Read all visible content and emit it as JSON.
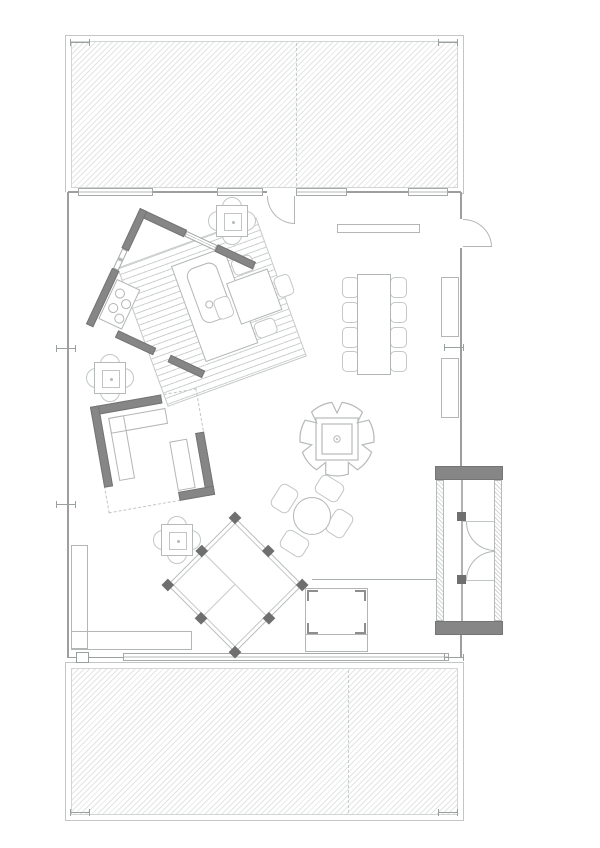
{
  "plan": {
    "title": "Single-storey cabin floor plan with north and south hatched decks",
    "drawing_type": "architectural floor plan, grayscale line drawing, no text labels",
    "colors": {
      "background": "#ffffff",
      "line": "#b3b6b6",
      "line_light": "#ced1d1",
      "wall_light": "#9e9e9e",
      "wall_dark": "#868686",
      "post_dark": "#6f6f6f",
      "deck_hatch": "#e3e4e4"
    },
    "fireplace_notches": 7,
    "areas": [
      {
        "id": "upper-deck",
        "label": "hatched deck terrace (top), split by a dashed seam, corner column ticks"
      },
      {
        "id": "main-room",
        "label": "open plan living / dining hall"
      },
      {
        "id": "kitchen",
        "label": "rotated square kitchen enclosure (25deg) with segmented dark walls and windows"
      },
      {
        "id": "floor-platform",
        "label": "striped timber floor platform rotated -20deg under kitchen island and table"
      },
      {
        "id": "room2",
        "label": "rotated square room (-10deg) with dark wall segments, dashed glazing and L cabinet"
      },
      {
        "id": "entry-vestibule",
        "label": "entry airlock on east wall with two dark end walls, hatched jambs and double swing doors"
      },
      {
        "id": "lower-deck",
        "label": "hatched deck terrace (bottom) with long window band and seam"
      }
    ],
    "furniture": [
      {
        "id": "range",
        "label": "4-burner cooktop in kitchen west corner",
        "burners": 4
      },
      {
        "id": "island",
        "label": "kitchen island with rounded sink and tap circle"
      },
      {
        "id": "platform-table",
        "label": "square table with 4 chairs on striped platform",
        "seats": 4
      },
      {
        "id": "cafe-table-north",
        "label": "small square table with 4 round chairs near north door",
        "seats": 4
      },
      {
        "id": "cafe-table-west",
        "label": "small square table with 4 round chairs at west wall",
        "seats": 4
      },
      {
        "id": "cafe-table-south",
        "label": "small square table with 4 round chairs south of kitchen",
        "seats": 4
      },
      {
        "id": "dining-table",
        "label": "long dining table with 8 chairs, 4 per side",
        "seats": 8
      },
      {
        "id": "sideboard",
        "label": "narrow wall shelf below north windows"
      },
      {
        "id": "wall-unit-upper",
        "label": "tall cabinet on east wall (upper)"
      },
      {
        "id": "wall-unit-lower",
        "label": "tall cabinet on east wall (lower)"
      },
      {
        "id": "fireplace",
        "label": "scalloped round fire pit with double square hearth and centre pin"
      },
      {
        "id": "round-table",
        "label": "round table with 4 rotated chairs",
        "seats": 4
      },
      {
        "id": "daybed-platform",
        "label": "45deg rotated lounge platform, double outline, 8 dark posts, sectional division"
      },
      {
        "id": "desk",
        "label": "square cabinet with corner brackets and bottom drawer band"
      },
      {
        "id": "l-bench",
        "label": "L-shaped bench in south-west corner"
      },
      {
        "id": "partition",
        "label": "low partition line from desk to vestibule door post"
      }
    ],
    "doors": [
      {
        "id": "north-door",
        "label": "swing door in north wall opening inward"
      },
      {
        "id": "east-door",
        "label": "swing door in east wall opening outward"
      },
      {
        "id": "vestibule-doors",
        "label": "pair of opposed swing doors inside entry airlock"
      }
    ],
    "windows": {
      "north_wall_segments": 4,
      "south_wall_band": 1,
      "kitchen_wall_segments": 2
    }
  }
}
